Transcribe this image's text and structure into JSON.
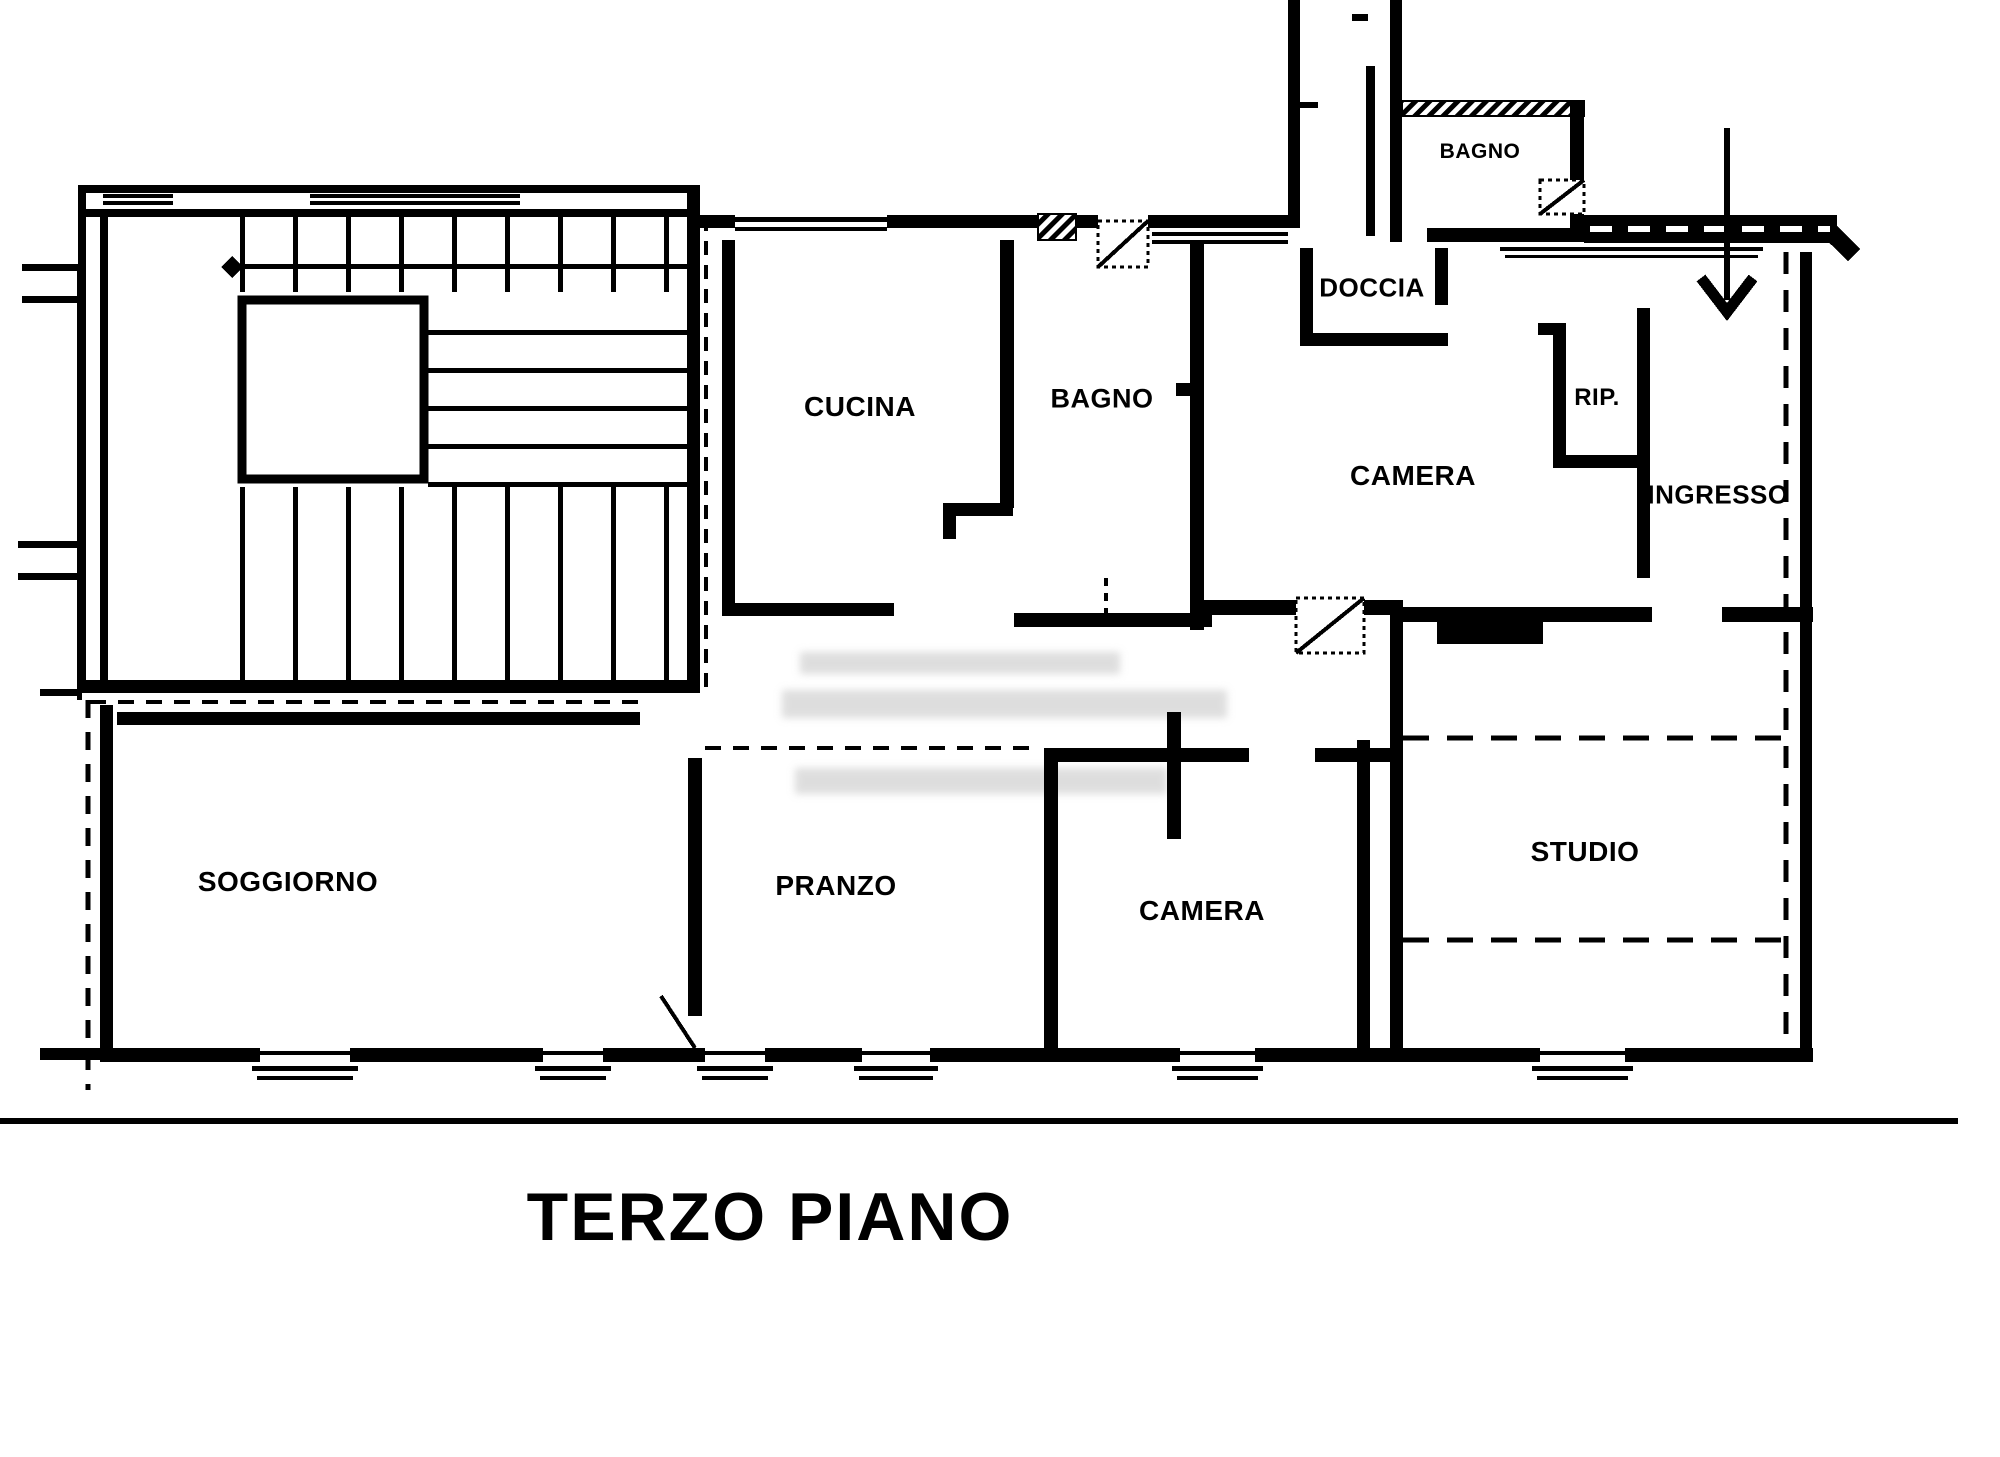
{
  "title": "TERZO PIANO",
  "colors": {
    "line": "#000000",
    "background": "#ffffff",
    "watermark": "#bdbdbd"
  },
  "icons": {
    "entrance_arrow": "↓"
  },
  "rooms": [
    {
      "id": "bagno-top",
      "label": "BAGNO"
    },
    {
      "id": "doccia",
      "label": "DOCCIA"
    },
    {
      "id": "cucina",
      "label": "CUCINA"
    },
    {
      "id": "bagno",
      "label": "BAGNO"
    },
    {
      "id": "camera",
      "label": "CAMERA"
    },
    {
      "id": "ripostiglio",
      "label": "RIP."
    },
    {
      "id": "ingresso",
      "label": "INGRESSO"
    },
    {
      "id": "soggiorno",
      "label": "SOGGIORNO"
    },
    {
      "id": "pranzo",
      "label": "PRANZO"
    },
    {
      "id": "camera-2",
      "label": "CAMERA"
    },
    {
      "id": "studio",
      "label": "STUDIO"
    }
  ]
}
